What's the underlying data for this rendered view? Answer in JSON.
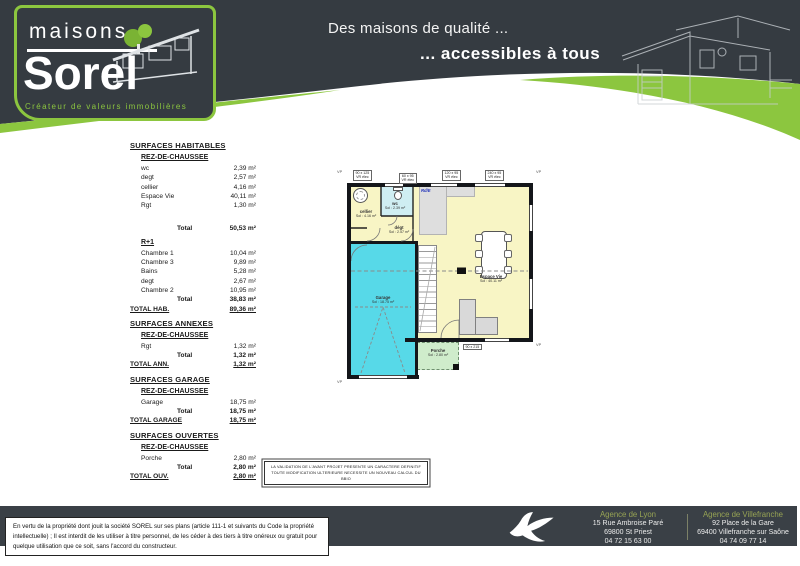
{
  "colors": {
    "accent_green": "#8cc63f",
    "header_dark": "#353b41",
    "garage_cyan": "#57d9e8",
    "room_yellow": "#f8f5c5",
    "wc_cyan": "#cfeef2",
    "porch_green": "#cfeccb",
    "agency_green": "#97a354"
  },
  "header": {
    "logo_top": "maisons",
    "logo_main": "Sorel",
    "logo_tagline": "Créateur de valeurs immobilières",
    "slogan_line1": "Des maisons de qualité ...",
    "slogan_line2": "... accessibles à tous"
  },
  "labels": {
    "total": "Total"
  },
  "surfaces": {
    "sections": [
      {
        "title": "SURFACES HABITABLES",
        "groups": [
          {
            "subtitle": "REZ-DE-CHAUSSEE",
            "rows": [
              {
                "label": "wc",
                "value": "2,39 m²"
              },
              {
                "label": "degt",
                "value": "2,57 m²"
              },
              {
                "label": "cellier",
                "value": "4,16 m²"
              },
              {
                "label": "Espace Vie",
                "value": "40,11 m²"
              },
              {
                "label": "Rgt",
                "value": "1,30 m²"
              }
            ],
            "total": "50,53 m²"
          },
          {
            "subtitle": "R+1",
            "rows": [
              {
                "label": "Chambre 1",
                "value": "10,04 m²"
              },
              {
                "label": "Chambre 3",
                "value": "9,89 m²"
              },
              {
                "label": "Bains",
                "value": "5,28 m²"
              },
              {
                "label": "degt",
                "value": "2,67 m²"
              },
              {
                "label": "Chambre 2",
                "value": "10,95 m²"
              }
            ],
            "total": "38,83 m²"
          }
        ],
        "total_label": "TOTAL HAB.",
        "total_value": "89,36 m²"
      },
      {
        "title": "SURFACES ANNEXES",
        "groups": [
          {
            "subtitle": "REZ-DE-CHAUSSEE",
            "rows": [
              {
                "label": "Rgt",
                "value": "1,32 m²"
              }
            ],
            "total": "1,32 m²"
          }
        ],
        "total_label": "TOTAL ANN.",
        "total_value": "1,32 m²"
      },
      {
        "title": "SURFACES GARAGE",
        "groups": [
          {
            "subtitle": "REZ-DE-CHAUSSEE",
            "rows": [
              {
                "label": "Garage",
                "value": "18,75 m²"
              }
            ],
            "total": "18,75 m²"
          }
        ],
        "total_label": "TOTAL GARAGE",
        "total_value": "18,75 m²"
      },
      {
        "title": "SURFACES OUVERTES",
        "groups": [
          {
            "subtitle": "REZ-DE-CHAUSSEE",
            "rows": [
              {
                "label": "Porche",
                "value": "2,80 m²"
              }
            ],
            "total": "2,80 m²"
          }
        ],
        "total_label": "TOTAL OUV.",
        "total_value": "2,80 m²"
      }
    ]
  },
  "plan": {
    "rooms": {
      "garage": {
        "name": "Garage",
        "area": "Sol : 18.75 m²"
      },
      "espace_vie": {
        "name": "Espace Vie",
        "area": "Sol : 40.11 m²"
      },
      "porche": {
        "name": "Porche",
        "area": "Sol : 2.80 m²"
      },
      "cellier": {
        "name": "cellier",
        "area": "Sol : 4.16 m²"
      },
      "wc": {
        "name": "wc",
        "area": "Sol : 2.39 m²"
      },
      "degagement": {
        "name": "dégt",
        "area": "Sol : 2.57 m²"
      }
    },
    "dims": {
      "d1": "90 x 125\nVR élec",
      "d2": "60 x 95\nVR élec",
      "d3": "120 x 95\nVR élec",
      "d4": "240 x 95\nVR élec",
      "d5": "90 x 215"
    },
    "corner_mark": "VP",
    "blue_mark": "Rd/E"
  },
  "note": {
    "line1": "LA VALIDATION DE L'AVANT PROJET PRESENTE UN CARACTERE DEFINITIF",
    "line2": "TOUTE MODIFICATION ULTERIEURE NECESSITE UN NOUVEAU CALCUL DU BBIO"
  },
  "footer": {
    "legal": "En vertu de la propriété dont jouit la société SOREL sur ses plans (article 111-1 et suivants du Code la propriété intellectuelle) ;  Il est interdit de les utiliser à titre personnel, de les céder à des tiers à titre onéreux ou gratuit pour quelque utilisation que ce soit, sans l'accord du constructeur.",
    "agencies": [
      {
        "name": "Agence de Lyon",
        "line1": "15 Rue Ambroise Paré",
        "line2": "69800 St Priest",
        "phone": "04 72 15 63 00"
      },
      {
        "name": "Agence de Villefranche",
        "line1": "92 Place de la Gare",
        "line2": "69400 Villefranche sur Saône",
        "phone": "04 74 09 77 14"
      }
    ]
  }
}
